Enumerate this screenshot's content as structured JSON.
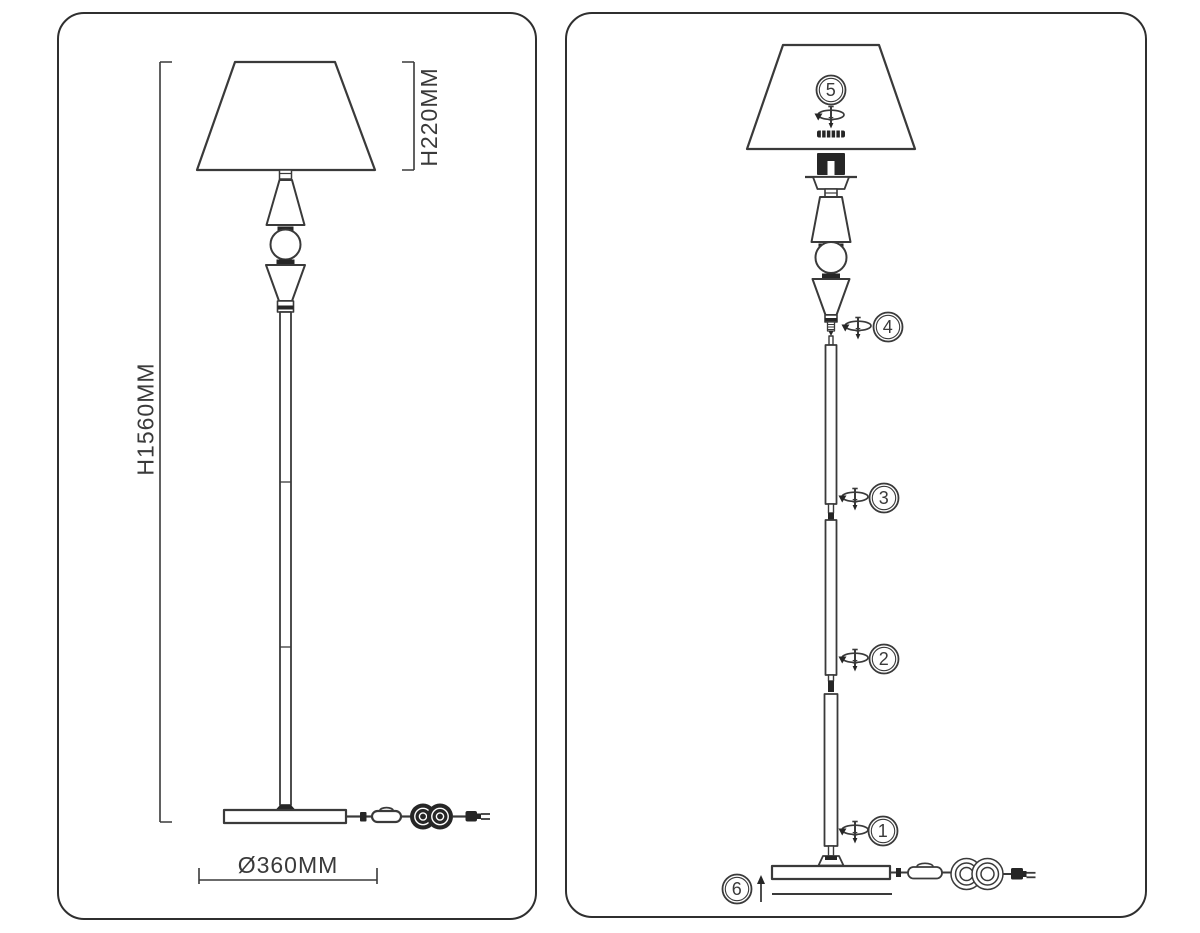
{
  "document": {
    "type": "floor-lamp-assembly-instruction-sheet"
  },
  "colors": {
    "line": "#3a3a3a",
    "dark_fill": "#262626",
    "background": "#ffffff"
  },
  "left_panel": {
    "name": "dimensions-view",
    "labels": {
      "total_height": "H1560MM",
      "shade_height": "H220MM",
      "base_diameter": "Ø360MM"
    }
  },
  "right_panel": {
    "name": "assembly-steps-view",
    "steps": [
      {
        "number": "1",
        "icon": "screw-rotation-icon"
      },
      {
        "number": "2",
        "icon": "screw-rotation-icon"
      },
      {
        "number": "3",
        "icon": "screw-rotation-icon"
      },
      {
        "number": "4",
        "icon": "screw-rotation-icon"
      },
      {
        "number": "5",
        "icon": "screw-rotation-icon"
      },
      {
        "number": "6",
        "icon": "arrow-up-icon"
      }
    ]
  }
}
